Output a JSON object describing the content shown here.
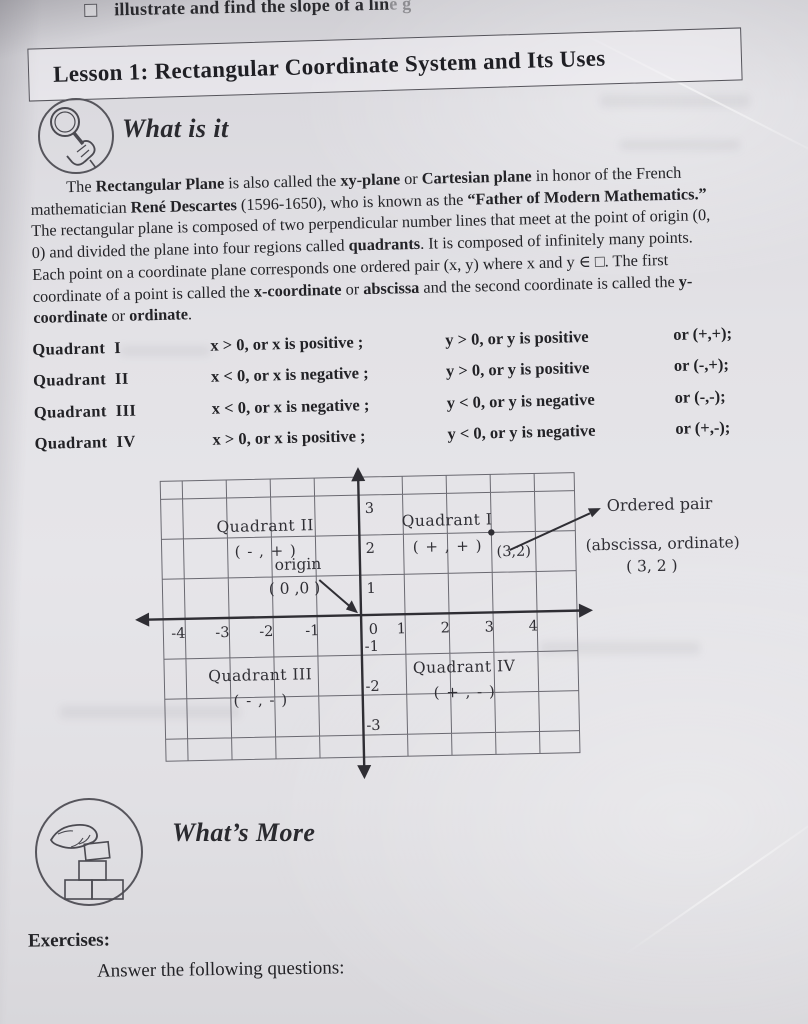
{
  "colors": {
    "paper": "#e4e3e7",
    "ink": "#26262b",
    "line_gray": "#4b4a51"
  },
  "top_bar": {
    "checkbox_icon": "empty-checkbox",
    "text": "illustrate and find the slope of a lin",
    "text_faded": "e g"
  },
  "lesson": {
    "title": "Lesson 1: Rectangular Coordinate System and Its Uses"
  },
  "what_is_it": {
    "icon": "magnifier-hand-icon",
    "heading": "What is it"
  },
  "intro": {
    "lines": [
      [
        {
          "t": "The ",
          "b": false
        },
        {
          "t": "Rectangular Plane",
          "b": true
        },
        {
          "t": " is also called the ",
          "b": false
        },
        {
          "t": "xy-plane",
          "b": true
        },
        {
          "t": " or ",
          "b": false
        },
        {
          "t": "Cartesian plane",
          "b": true
        },
        {
          "t": " in honor of the French",
          "b": false
        }
      ],
      [
        {
          "t": "mathematician ",
          "b": false
        },
        {
          "t": "René Descartes",
          "b": true
        },
        {
          "t": " (1596-1650), who is known as the ",
          "b": false
        },
        {
          "t": "“Father of Modern Mathematics.”",
          "b": true
        }
      ],
      [
        {
          "t": "The rectangular plane is composed of two perpendicular number lines that meet at the point of origin (0,",
          "b": false
        }
      ],
      [
        {
          "t": "0) and divided the plane into four regions called ",
          "b": false
        },
        {
          "t": "quadrants",
          "b": true
        },
        {
          "t": ". It is composed of infinitely many points.",
          "b": false
        }
      ],
      [
        {
          "t": "Each point on a coordinate plane corresponds one ordered pair (x, y) where x and y ∈ □. The first",
          "b": false
        }
      ],
      [
        {
          "t": "coordinate of a point is called the ",
          "b": false
        },
        {
          "t": "x-coordinate",
          "b": true
        },
        {
          "t": " or ",
          "b": false
        },
        {
          "t": "abscissa",
          "b": true
        },
        {
          "t": " and the second coordinate is called the ",
          "b": false
        },
        {
          "t": "y-",
          "b": true
        }
      ],
      [
        {
          "t": "coordinate",
          "b": true
        },
        {
          "t": " or ",
          "b": false
        },
        {
          "t": "ordinate",
          "b": true
        },
        {
          "t": ".",
          "b": false
        }
      ]
    ]
  },
  "quadrant_table": {
    "rows": [
      {
        "label": "Quadrant  I",
        "x": "x > 0, or x is positive ;",
        "y": "y > 0, or y is positive",
        "sign": "or (+,+);"
      },
      {
        "label": "Quadrant  II",
        "x": "x < 0, or x is negative ;",
        "y": "y > 0, or y is positive",
        "sign": "or (-,+);"
      },
      {
        "label": "Quadrant  III",
        "x": "x < 0, or x is negative ;",
        "y": "y < 0, or y is negative",
        "sign": "or (-,-);"
      },
      {
        "label": "Quadrant  IV",
        "x": "x > 0, or x is positive ;",
        "y": "y < 0, or y is negative",
        "sign": "or (+,-);"
      }
    ]
  },
  "diagram": {
    "x_ticks": [
      "-4",
      "-3",
      "-2",
      "-1",
      "0",
      "1",
      "2",
      "3",
      "4"
    ],
    "y_ticks": [
      "3",
      "2",
      "1",
      "-1",
      "-2",
      "-3"
    ],
    "quadrants": {
      "q1": {
        "name": "Quadrant I",
        "pair": "( + , + )"
      },
      "q2": {
        "name": "Quadrant II",
        "pair": "( - , + )"
      },
      "q3": {
        "name": "Quadrant III",
        "pair": "( - , - )"
      },
      "q4": {
        "name": "Quadrant IV",
        "pair": "( + , - )"
      }
    },
    "origin": {
      "line1": "origin",
      "line2": "( 0 ,0 )"
    },
    "point": {
      "label": "(3,2)",
      "x": 3,
      "y": 2
    },
    "annotation": {
      "title": "Ordered pair",
      "subtitle": "(abscissa, ordinate)",
      "pair": "( 3, 2 )"
    }
  },
  "whats_more": {
    "icon": "hand-stacking-blocks-icon",
    "heading": "What’s More"
  },
  "exercises": {
    "heading": "Exercises:",
    "instruction": "Answer the following questions:"
  }
}
